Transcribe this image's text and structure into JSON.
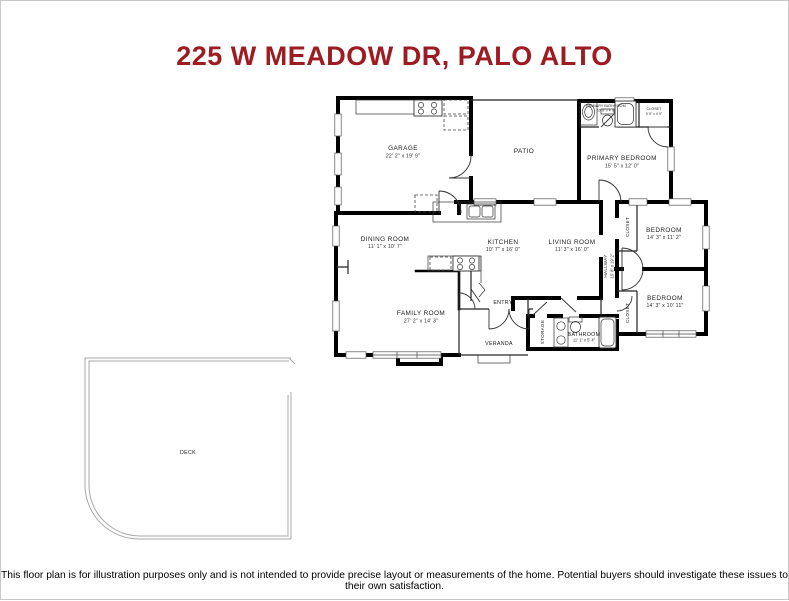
{
  "page": {
    "title": "225 W MEADOW DR, PALO ALTO",
    "disclaimer": "This floor plan is for illustration purposes only and is not intended to provide precise layout or measurements of the home. Potential buyers should investigate these issues to their own satisfaction."
  },
  "colors": {
    "title": "#9d1c21",
    "walls": "#000000",
    "deck_line": "#a8a8a8"
  },
  "rooms": {
    "garage": {
      "label": "GARAGE",
      "dims": "22' 2\" x 19' 9\""
    },
    "patio": {
      "label": "PATIO"
    },
    "primary_bathroom": {
      "label": "PRIMARY BATHROOM",
      "dims": "10' 8\" x 4' 9\""
    },
    "primary_closet": {
      "label": "CLOSET",
      "dims": "5' 8\" x 4' 9\""
    },
    "primary_bedroom": {
      "label": "PRIMARY BEDROOM",
      "dims": "15' 5\" x 12' 0\""
    },
    "dining_room": {
      "label": "DINING ROOM",
      "dims": "11' 1\" x 10' 7\""
    },
    "kitchen": {
      "label": "KITCHEN",
      "dims": "10' 7\" x 16' 0\""
    },
    "living_room": {
      "label": "LIVING ROOM",
      "dims": "11' 3\" x 16' 0\""
    },
    "hallway": {
      "label": "HALLWAY",
      "dims": "15' 8\" x 19' 2\""
    },
    "closet_top": {
      "label": "CLOSET"
    },
    "bedroom_top": {
      "label": "BEDROOM",
      "dims": "14' 3\" x 11' 2\""
    },
    "closet_bottom": {
      "label": "CLOSET"
    },
    "bedroom_bottom": {
      "label": "BEDROOM",
      "dims": "14' 3\" x 10' 11\""
    },
    "family_room": {
      "label": "FAMILY ROOM",
      "dims": "27' 2\" x 14' 3\""
    },
    "entry": {
      "label": "ENTRY"
    },
    "veranda": {
      "label": "VERANDA"
    },
    "storage": {
      "label": "STORAGE"
    },
    "bathroom": {
      "label": "BATHROOM",
      "dims": "11' 1\" x 5' 4\""
    },
    "deck": {
      "label": "DECK"
    }
  }
}
